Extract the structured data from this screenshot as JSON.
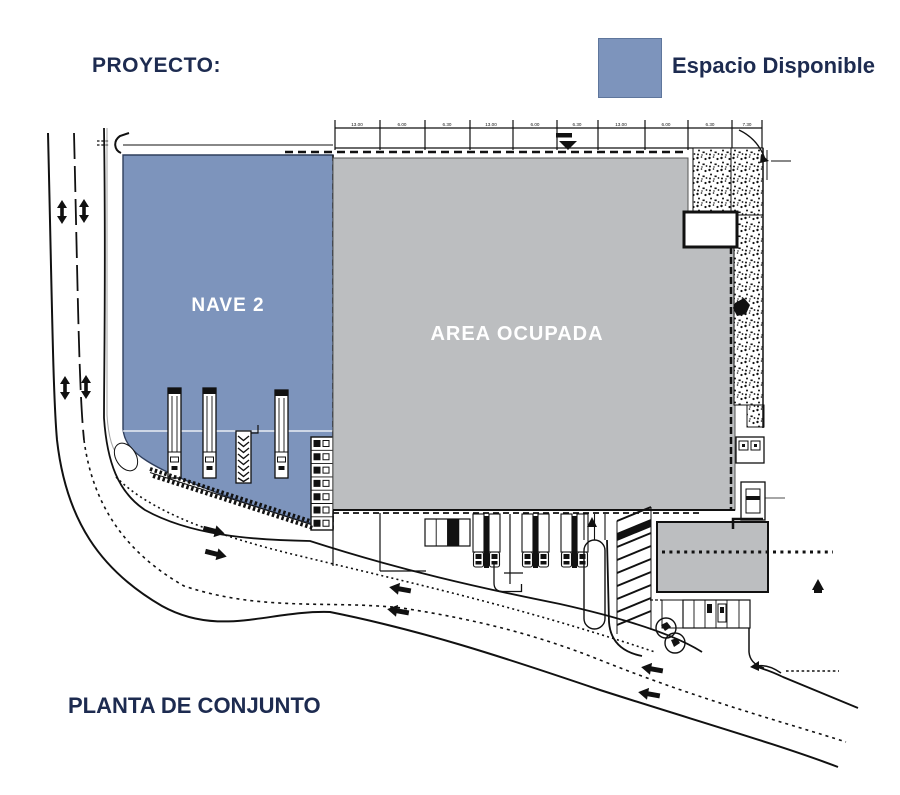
{
  "header": {
    "project_label": "PROYECTO:"
  },
  "legend": {
    "label": "Espacio Disponible",
    "swatch_color": "#7d94bc"
  },
  "plan": {
    "available_area_label": "NAVE 2",
    "occupied_area_label": "AREA OCUPADA",
    "dimension_labels": [
      "13.00",
      "6.00",
      "6.30",
      "13.00",
      "6.00",
      "6.30",
      "13.00",
      "6.00",
      "6.30",
      "7.30"
    ]
  },
  "footer": {
    "title": "PLANTA DE CONJUNTO"
  },
  "colors": {
    "available_fill": "#7d94bc",
    "occupied_fill": "#bcbec0",
    "text_navy": "#1d2b50",
    "linework": "#111111"
  },
  "icons": {
    "road_two_way": "up-down-arrow",
    "road_direction_left": "left-arrow",
    "road_direction_right": "right-arrow",
    "benchmark": "filled-down-triangle"
  }
}
